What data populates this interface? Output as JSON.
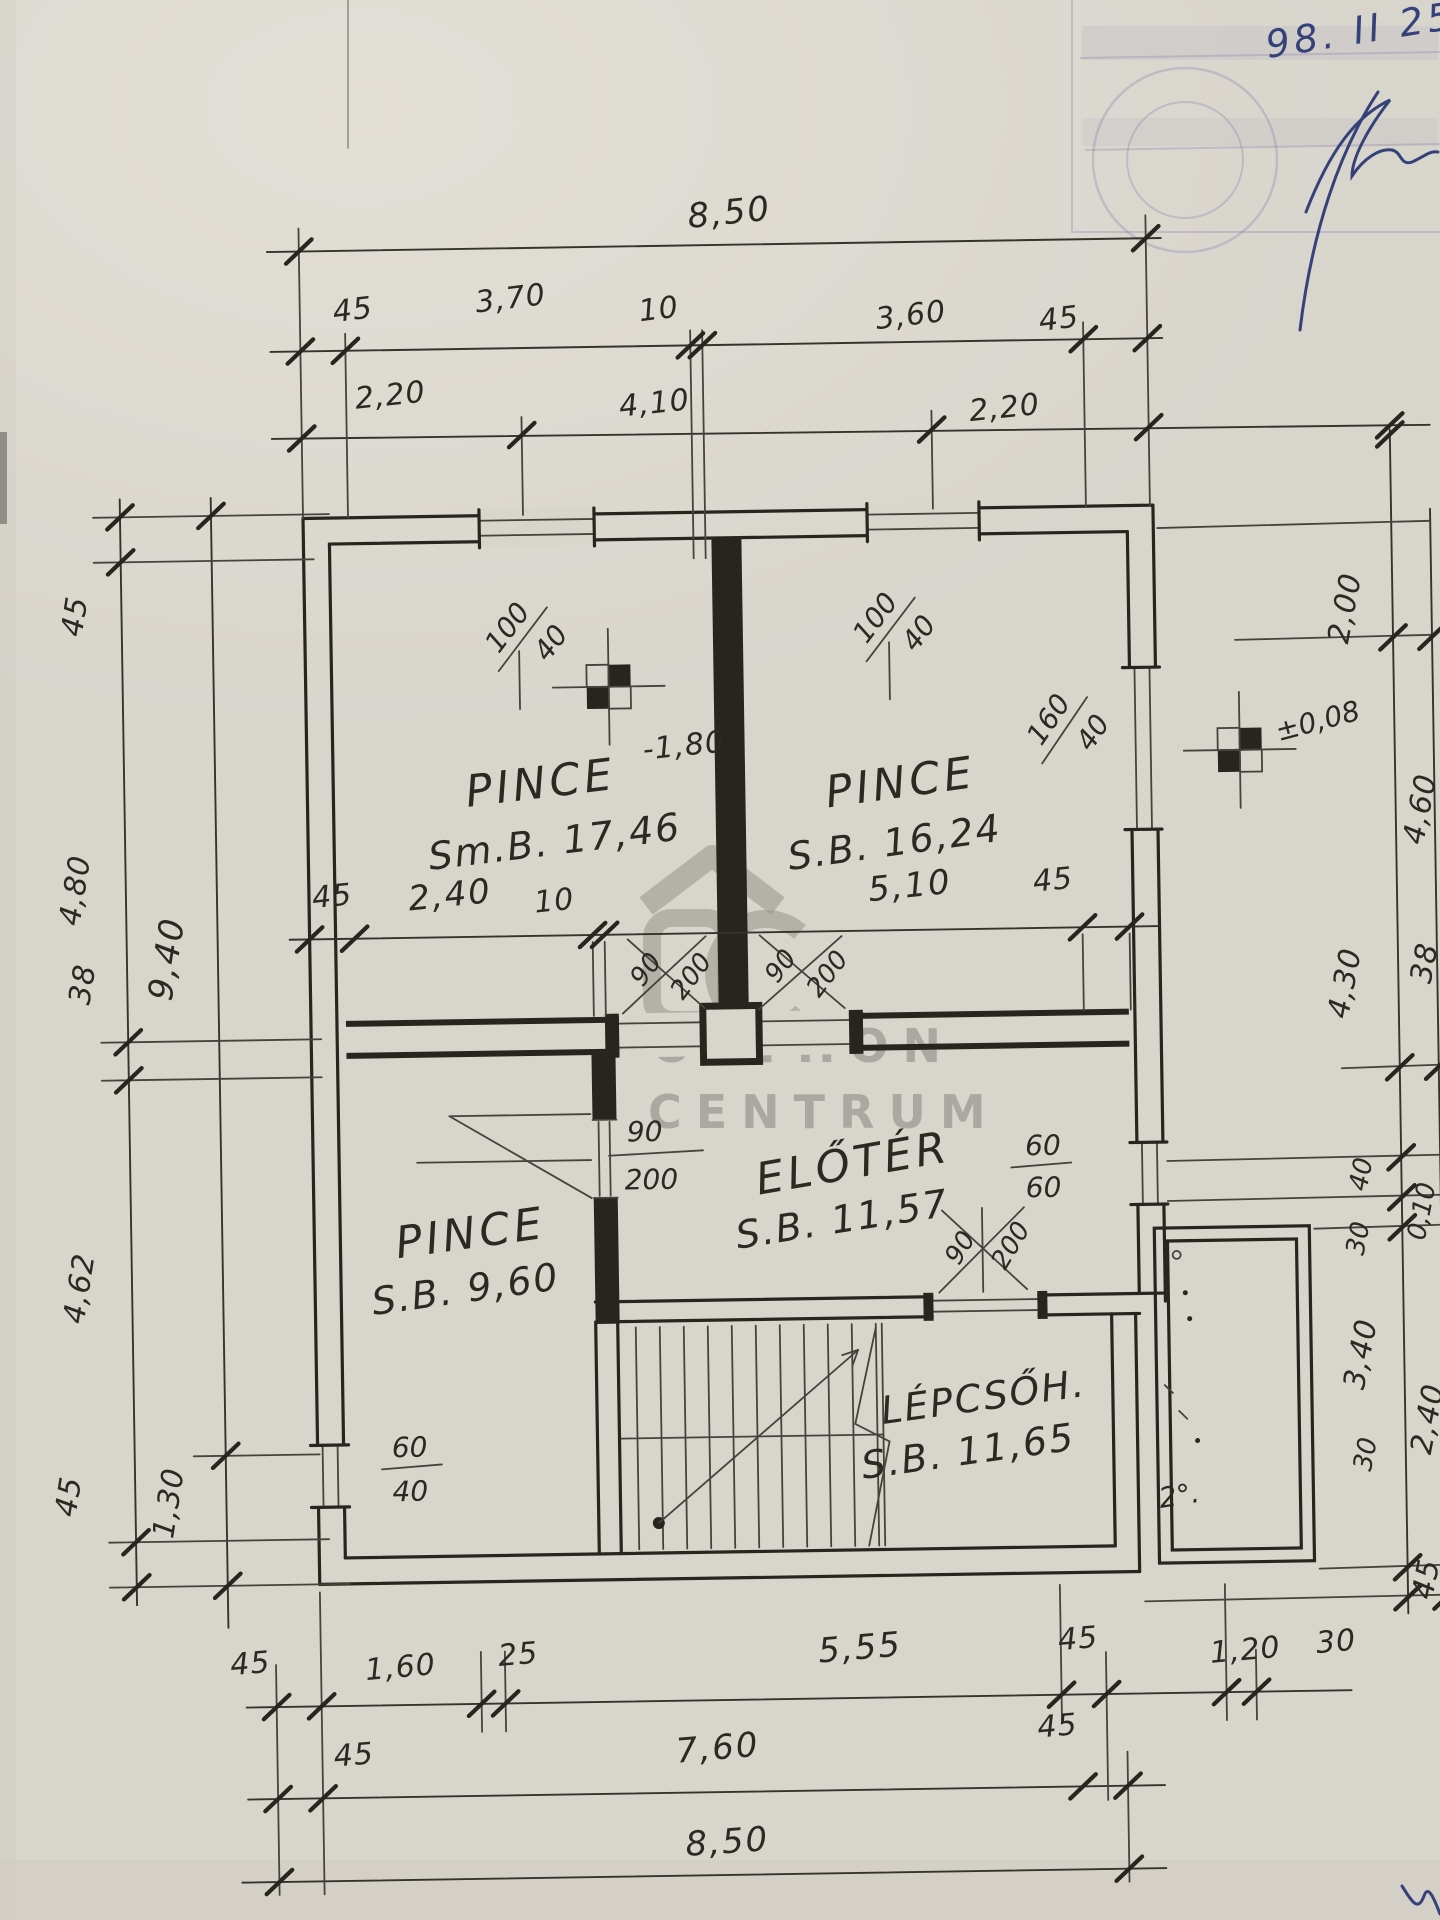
{
  "annotations": {
    "date": "98. II 25."
  },
  "watermark": {
    "line1": "OTTHON",
    "line2": "CENTRUM"
  },
  "rooms": [
    {
      "name": "PINCE",
      "area": "Sm.B. 17,46"
    },
    {
      "name": "PINCE",
      "area": "S.B. 16,24"
    },
    {
      "name": "PINCE",
      "area": "S.B. 9,60"
    },
    {
      "name": "ELŐTÉR",
      "area": "S.B. 11,57"
    },
    {
      "name": "LÉPCSŐH.",
      "area": "S.B. 11,65"
    }
  ],
  "levels": {
    "basement": "-1,80",
    "entry": "±0,08"
  },
  "terrace_mark": "2°.",
  "windows": [
    {
      "w": "100",
      "h": "40"
    },
    {
      "w": "100",
      "h": "40"
    },
    {
      "w": "160",
      "h": "40"
    },
    {
      "w": "60",
      "h": "60"
    },
    {
      "w": "60",
      "h": "40"
    }
  ],
  "doors": [
    {
      "w": "90",
      "h": "200"
    },
    {
      "w": "90",
      "h": "200"
    },
    {
      "w": "90",
      "h": "200"
    },
    {
      "w": "90",
      "h": "200"
    }
  ],
  "dims": {
    "top1": "8,50",
    "top2": [
      "45",
      "3,70",
      "10",
      "3,60",
      "45"
    ],
    "top3": [
      "2,20",
      "4,10",
      "2,20"
    ],
    "mid": [
      "45",
      "2,40",
      "10",
      "5,10",
      "45"
    ],
    "left_inner": [
      "45",
      "4,80",
      "38",
      "4,62",
      "45"
    ],
    "left_outer": [
      "9,40",
      "1,30"
    ],
    "right_inner": [
      "2,00",
      "4,30",
      "40",
      "30",
      "3,40",
      "30"
    ],
    "right_outer": [
      "4,60",
      "38",
      "0,10",
      "2,40",
      "45"
    ],
    "bottom1": [
      "45",
      "1,60",
      "25",
      "5,55",
      "45",
      "1,20",
      "30"
    ],
    "bottom2": [
      "45",
      "7,60",
      "45"
    ],
    "bottom3": "8,50"
  }
}
